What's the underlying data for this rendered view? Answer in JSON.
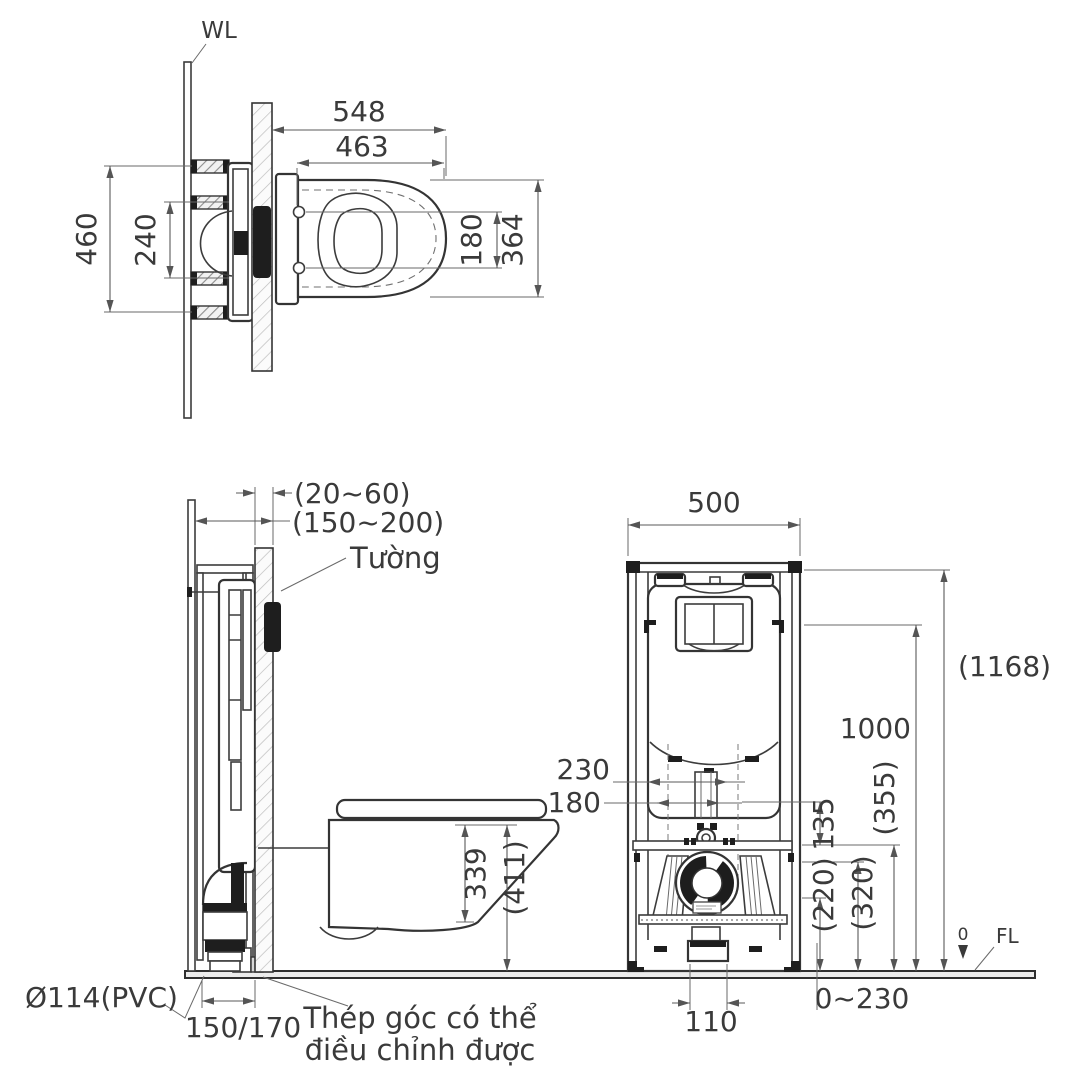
{
  "top_view": {
    "wall_line_label": "WL",
    "dim_total_width": "548",
    "dim_mount_width": "463",
    "dim_total_depth": "460",
    "dim_bracket_pitch": "240",
    "dim_bolt_pitch": "180",
    "dim_bowl_depth": "364"
  },
  "side_view": {
    "dim_panel_thickness": "(20~60)",
    "dim_wall_offset": "(150~200)",
    "wall_label": "Tường",
    "dim_bowl_height": "339",
    "dim_rim_floor_height": "(411)",
    "drain_pipe_label": "Ø114(PVC)",
    "dim_frame_foot_depth": "150/170",
    "bracket_note_line1": "Thép góc có thể",
    "bracket_note_line2": "điều chỉnh được"
  },
  "front_view": {
    "dim_frame_width": "500",
    "dim_frame_total_height": "(1168)",
    "dim_flush_button_height": "1000",
    "dim_355": "(355)",
    "dim_320": "(320)",
    "dim_135": "135",
    "dim_220": "(220)",
    "dim_230": "230",
    "dim_180": "180",
    "dim_outlet_width": "110",
    "dim_foot_adjust": "0~230",
    "floor_zero_label": "0",
    "floor_line_label": "FL"
  }
}
